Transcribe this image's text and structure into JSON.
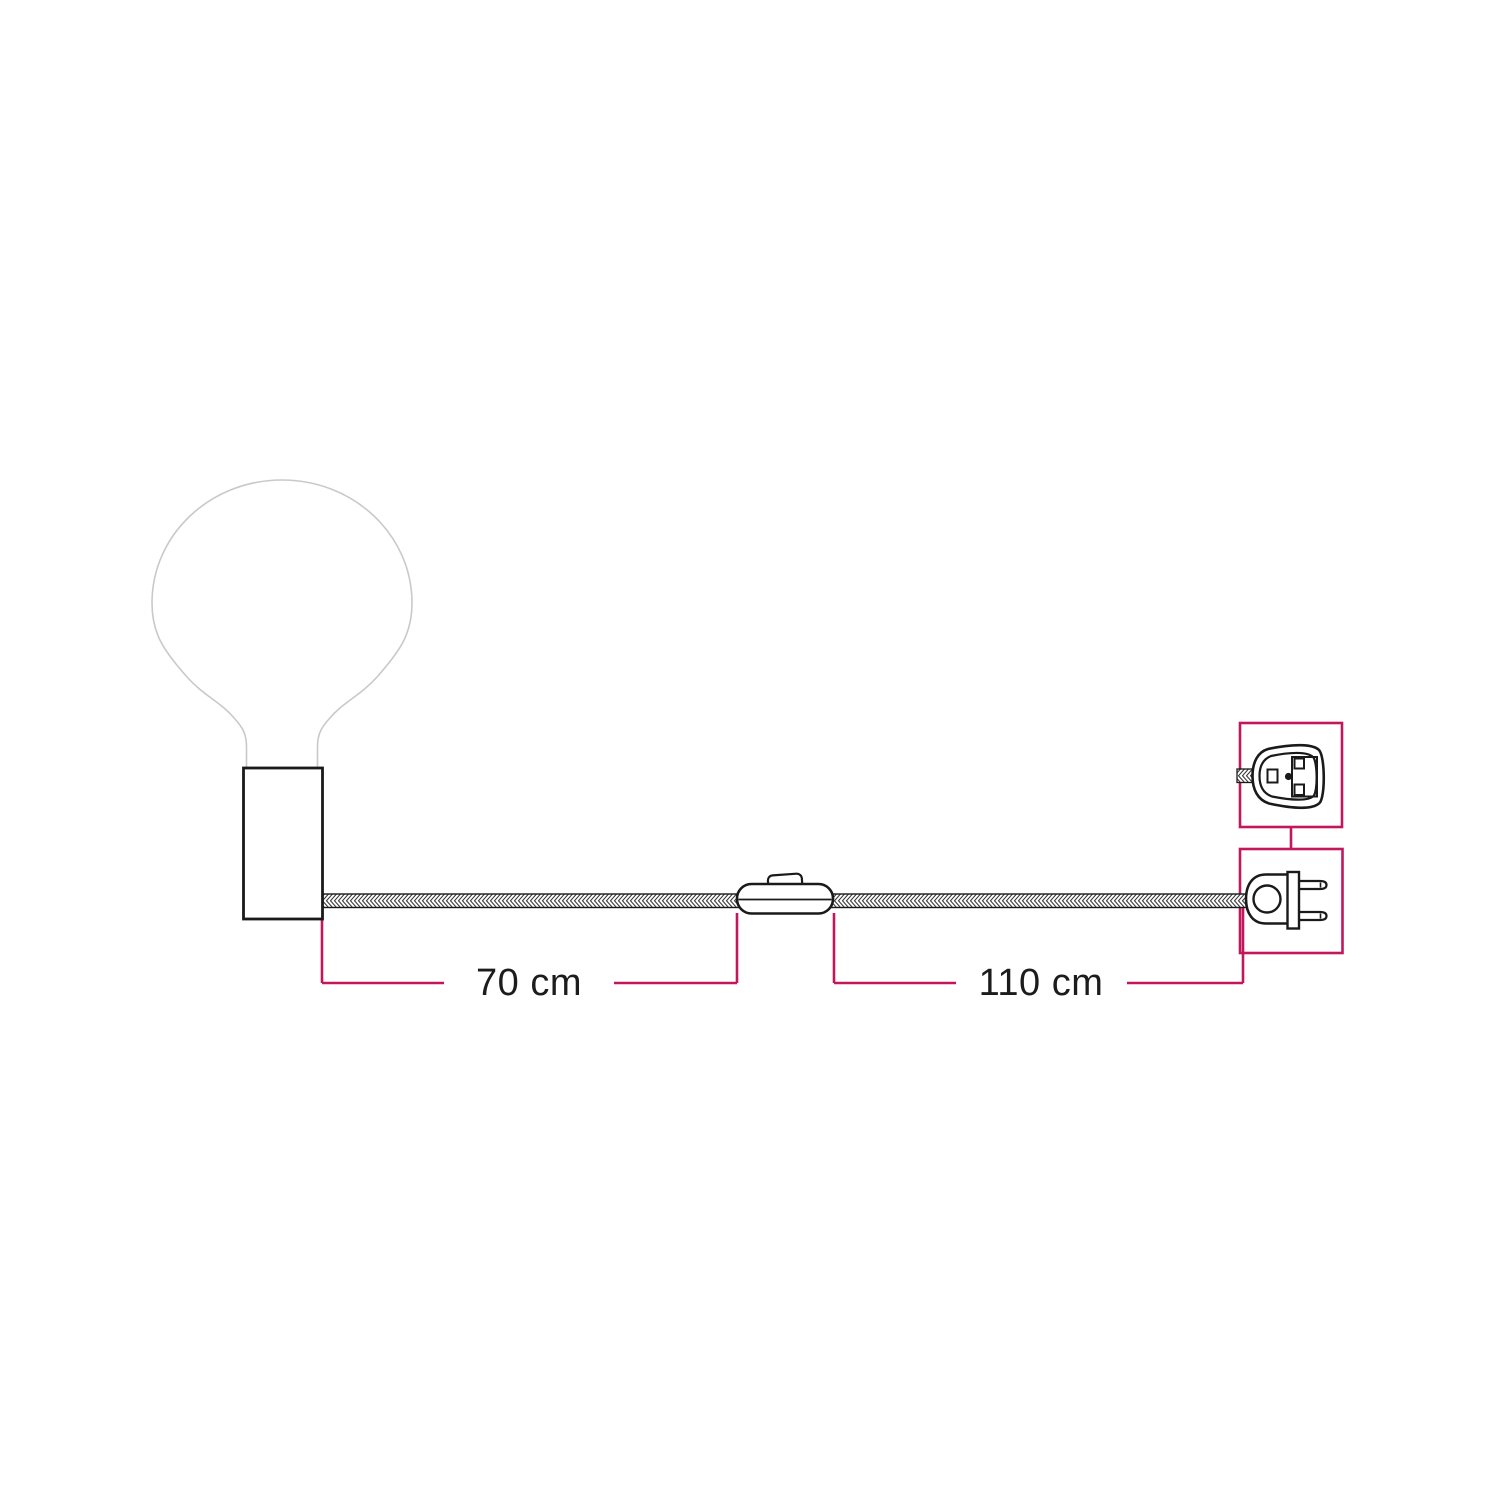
{
  "canvas": {
    "width": 1500,
    "height": 1500,
    "background": "#ffffff"
  },
  "colors": {
    "accent_pink": "#c2185b",
    "outline_black": "#1a1a1a",
    "bulb_outline_gray": "#c9c9c9",
    "label_text": "#1c1c1c"
  },
  "diagram": {
    "dimensions": [
      {
        "label": "70 cm"
      },
      {
        "label": "110 cm"
      }
    ],
    "components": {
      "bulb": "globe-bulb-icon",
      "holder": "cylindrical-lamp-holder-icon",
      "cable": "braided-textile-cable-icon",
      "switch": "inline-switch-icon",
      "plug_side_view": "two-pin-plug-side-icon",
      "plug_front_view": "two-pin-plug-front-icon"
    }
  }
}
